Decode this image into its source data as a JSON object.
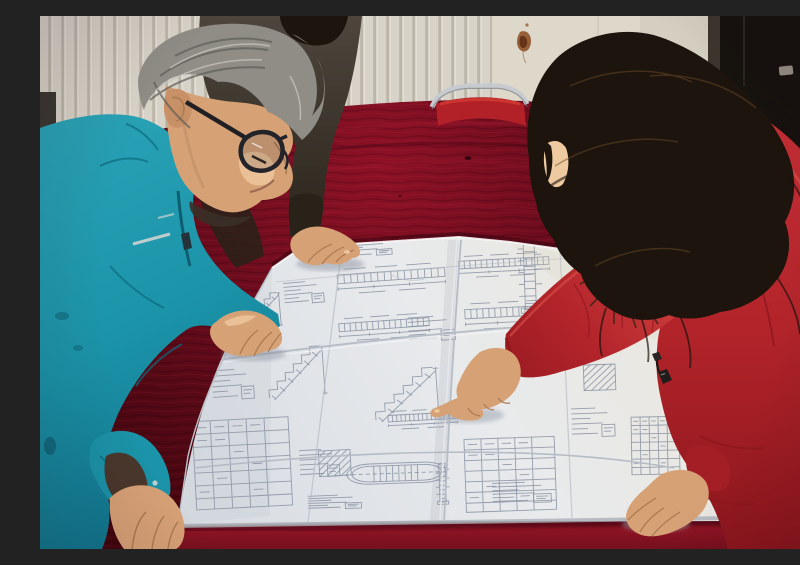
{
  "scene": {
    "description": "Two workers study a large folded engineering blueprint spread over a dark red velvet-covered table while a woman in a red down coat with an orange fur-trimmed hood points at a detail of the drawing.",
    "setting": "indoor room with a white radiator wall, a rust-stained panel, a chrome-framed red chair and a dark door"
  },
  "people": [
    {
      "id": "worker-left",
      "description": "Middle-aged man with gray hair and black glasses wearing a teal work jacket, leaning over the drawing with both hands on the table"
    },
    {
      "id": "colleague-behind",
      "description": "Partially hidden person in a dark jacket resting one hand flat on the top edge of the drawing"
    },
    {
      "id": "woman-right",
      "description": "Woman with long dark wavy hair in a red down coat with orange fur-trimmed hood, pointing at the blueprint with her index finger, other hand resting on the sheet"
    }
  ],
  "objects": [
    {
      "id": "blueprint",
      "description": "Large folded white engineering drawing sheet covered with small technical details, schedules and dimension lines"
    },
    {
      "id": "table",
      "description": "Table draped in dark crimson velvet"
    },
    {
      "id": "chair",
      "description": "Red chair with chrome tube frame behind the table"
    },
    {
      "id": "radiator",
      "description": "White vertical-fin radiator wall on the left"
    },
    {
      "id": "door",
      "description": "Near-black door with small metal latch on the right"
    }
  ],
  "colors": {
    "wall": "#d8d3c8",
    "wall_line": "#b3ac9e",
    "wall_right": "#ded8cb",
    "door": "#16120e",
    "door_frame": "#3c362e",
    "latch": "#968f86",
    "chair_red": "#b22128",
    "chrome": "#c7cbd0",
    "velvet": "#6b0c1d",
    "velvet_dark": "#43060f",
    "velvet_bright": "#8e1424",
    "paper": "#e8eaec",
    "paper_shade": "#ccd1d8",
    "ink": "#8790a2",
    "teal": "#1b93a8",
    "teal_dark": "#0d6b80",
    "teal_light": "#45b5c8",
    "skin": "#d7a176",
    "skin_dark": "#aa7a50",
    "skin_light": "#efc9a0",
    "hair_gray": "#8f8d86",
    "hair_gray_dark": "#5d5b55",
    "hair_gray_light": "#c6c3bb",
    "hair_black": "#1c140d",
    "hair_brown": "#6b4b28",
    "dark_clothes": "#443d35",
    "dark_clothes_deep": "#282219",
    "coat": "#bb272d",
    "coat_light": "#d2423e",
    "coat_dark": "#8c161d",
    "fur": "#c3791f",
    "fur_light": "#e8a83c",
    "fur_dark": "#3a2410",
    "stain": "#8a4a20"
  },
  "blueprint": {
    "sheet": {
      "folds_vertical": 3,
      "folds_horizontal": 3
    },
    "figures": [
      {
        "kind": "schedule-table",
        "x": 150,
        "y": 404,
        "w": 100,
        "h": 92,
        "rot": -3
      },
      {
        "kind": "rows",
        "x": 168,
        "y": 350,
        "w": 48,
        "h": 44,
        "rot": -4
      },
      {
        "kind": "stair",
        "x": 222,
        "y": 328,
        "w": 62,
        "h": 58,
        "rot": -4
      },
      {
        "kind": "rows",
        "x": 256,
        "y": 430,
        "w": 46,
        "h": 40,
        "rot": -3
      },
      {
        "kind": "hatch",
        "x": 276,
        "y": 432,
        "w": 36,
        "h": 32,
        "rot": -3
      },
      {
        "kind": "elev",
        "x": 294,
        "y": 246,
        "w": 112,
        "h": 44,
        "rot": -4
      },
      {
        "kind": "elev",
        "x": 296,
        "y": 296,
        "w": 94,
        "h": 40,
        "rot": -4
      },
      {
        "kind": "rows",
        "x": 240,
        "y": 264,
        "w": 46,
        "h": 32,
        "rot": -5
      },
      {
        "kind": "elev",
        "x": 416,
        "y": 234,
        "w": 94,
        "h": 38,
        "rot": -3
      },
      {
        "kind": "elev",
        "x": 422,
        "y": 280,
        "w": 100,
        "h": 46,
        "rot": -3
      },
      {
        "kind": "stair",
        "x": 328,
        "y": 350,
        "w": 70,
        "h": 58,
        "rot": -4
      },
      {
        "kind": "oval",
        "x": 304,
        "y": 436,
        "w": 104,
        "h": 46,
        "rot": -2
      },
      {
        "kind": "schedule-table",
        "x": 422,
        "y": 422,
        "w": 94,
        "h": 76,
        "rot": -2
      },
      {
        "kind": "rows",
        "x": 364,
        "y": 298,
        "w": 54,
        "h": 36,
        "rot": -4
      },
      {
        "kind": "column",
        "x": 468,
        "y": 226,
        "w": 42,
        "h": 74,
        "rot": -2
      },
      {
        "kind": "rows",
        "x": 548,
        "y": 294,
        "w": 54,
        "h": 40,
        "rot": -2
      },
      {
        "kind": "hatch",
        "x": 541,
        "y": 346,
        "w": 36,
        "h": 32,
        "rot": -2
      },
      {
        "kind": "rows",
        "x": 528,
        "y": 388,
        "w": 50,
        "h": 42,
        "rot": -2
      },
      {
        "kind": "schedule-table",
        "x": 590,
        "y": 400,
        "w": 50,
        "h": 60,
        "rot": -1
      },
      {
        "kind": "rows",
        "x": 296,
        "y": 226,
        "w": 60,
        "h": 20,
        "rot": -4
      },
      {
        "kind": "elev",
        "x": 346,
        "y": 390,
        "w": 72,
        "h": 32,
        "rot": -3
      },
      {
        "kind": "rows",
        "x": 426,
        "y": 354,
        "w": 52,
        "h": 28,
        "rot": -3
      },
      {
        "kind": "rows",
        "x": 264,
        "y": 478,
        "w": 62,
        "h": 20,
        "rot": -2
      },
      {
        "kind": "rows",
        "x": 448,
        "y": 464,
        "w": 68,
        "h": 30,
        "rot": -2
      },
      {
        "kind": "column",
        "x": 390,
        "y": 446,
        "w": 24,
        "h": 44,
        "rot": -2
      },
      {
        "kind": "stair",
        "x": 196,
        "y": 276,
        "w": 44,
        "h": 40,
        "rot": -5
      }
    ]
  }
}
